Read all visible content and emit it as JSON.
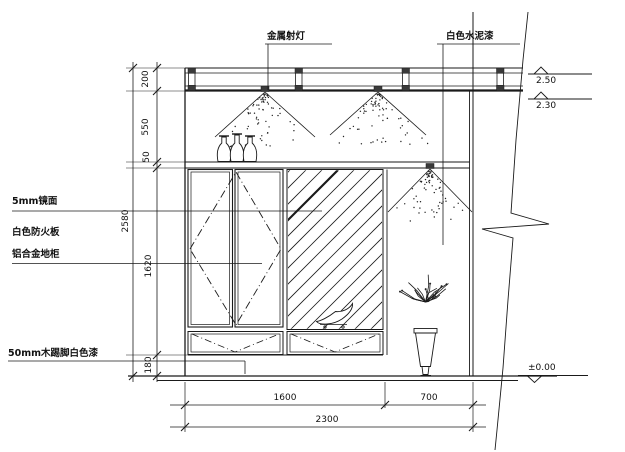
{
  "annotations": {
    "spotlight": "金属射灯",
    "cement_paint": "白色水泥漆",
    "mirror": "5mm镜面",
    "fire_board": "白色防火板",
    "cabinet": "铝合金地柜",
    "skirting": "50mm木踢脚白色漆"
  },
  "dimensions": {
    "vertical": {
      "total": "2580",
      "track": "200",
      "upper": "550",
      "shelf": "50",
      "body": "1620",
      "base": "180"
    },
    "horizontal": {
      "left": "1600",
      "right": "700",
      "total": "2300"
    }
  },
  "levels": {
    "track_top": "2.50",
    "track_bottom": "2.30",
    "floor": "±0.00"
  },
  "colors": {
    "line": "#1a1a1a",
    "background": "#ffffff"
  }
}
